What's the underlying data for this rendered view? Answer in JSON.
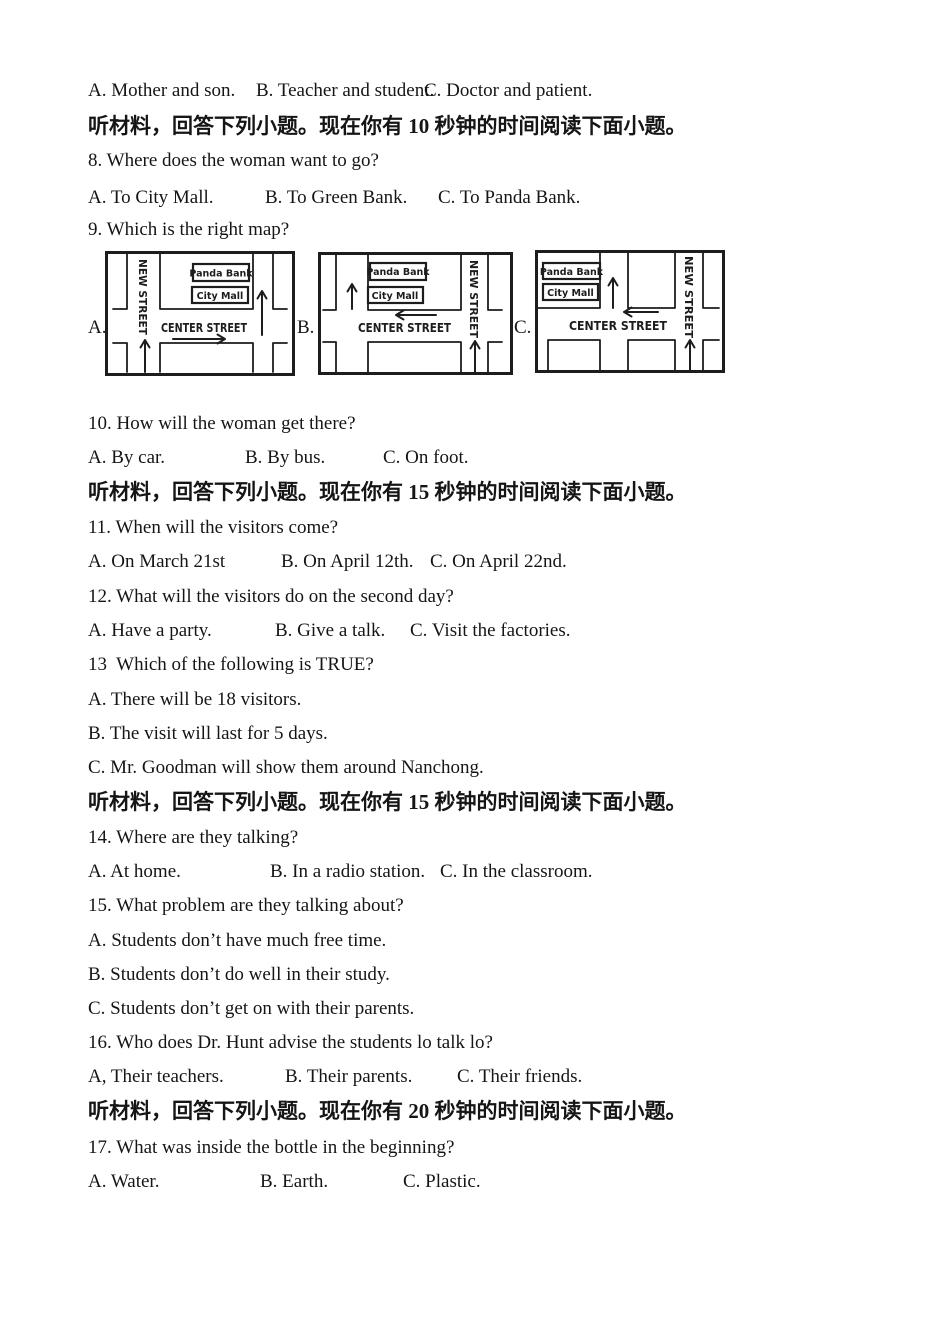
{
  "document": {
    "sections": {
      "s1": "听材料，回答下列小题。现在你有 10 秒钟的时间阅读下面小题。",
      "s2": "听材料，回答下列小题。现在你有 15 秒钟的时间阅读下面小题。",
      "s3": "听材料，回答下列小题。现在你有 15 秒钟的时间阅读下面小题。",
      "s4": "听材料，回答下列小题。现在你有 20 秒钟的时间阅读下面小题。"
    },
    "q7_options": {
      "a": "A. Mother and son.",
      "b": "B. Teacher and student.",
      "c": "C. Doctor and patient."
    },
    "q8": {
      "text": "8. Where does the woman want to go?",
      "a": "A. To City Mall.",
      "b": "B. To Green Bank.",
      "c": "C. To Panda Bank."
    },
    "q9": {
      "text": "9. Which is the right map?",
      "label_a": "A.",
      "label_b": "B.",
      "label_c": "C."
    },
    "q10": {
      "text": "10. How will the woman get there?",
      "a": "A. By car.",
      "b": "B. By bus.",
      "c": "C. On foot."
    },
    "q11": {
      "text": "11. When will the visitors come?",
      "a": "A. On March 21st",
      "b": "B. On April 12th.",
      "c": "C. On April 22nd."
    },
    "q12": {
      "text": "12. What will the visitors do on the second day?",
      "a": "A. Have a party.",
      "b": "B. Give a talk.",
      "c": "C. Visit the factories."
    },
    "q13": {
      "text": "13  Which of the following is TRUE?",
      "a": "A. There will be 18 visitors.",
      "b": "B. The visit will last for 5 days.",
      "c": "C. Mr. Goodman will show them around Nanchong."
    },
    "q14": {
      "text": "14. Where are they talking?",
      "a": "A. At home.",
      "b": "B. In a radio station.",
      "c": "C. In the classroom."
    },
    "q15": {
      "text": "15. What problem are they talking about?",
      "a": "A. Students don’t have much free time.",
      "b": "B. Students don’t do well in their study.",
      "c": "C. Students don’t get on with their parents."
    },
    "q16": {
      "text": "16. Who does Dr. Hunt advise the students lo talk lo?",
      "a": "A, Their teachers.",
      "b": "B. Their parents.",
      "c": "C. Their friends."
    },
    "q17": {
      "text": "17. What was inside the bottle in the beginning?",
      "a": "A. Water.",
      "b": "B. Earth.",
      "c": "C. Plastic."
    }
  },
  "maps": {
    "a": {
      "vertical_street": "NEW STREET",
      "horizontal_street": "CENTER STREET",
      "building1": "Panda Bank",
      "building2": "City Mall"
    },
    "b": {
      "vertical_street": "NEW STREET",
      "horizontal_street": "CENTER STREET",
      "building1": "Panda Bank",
      "building2": "City Mall"
    },
    "c": {
      "vertical_street": "NEW STREET",
      "horizontal_street": "CENTER STREET",
      "building1": "Panda Bank",
      "building2": "City Mall"
    }
  },
  "colors": {
    "ink": "#1d1d1d",
    "paper": "#ffffff"
  }
}
